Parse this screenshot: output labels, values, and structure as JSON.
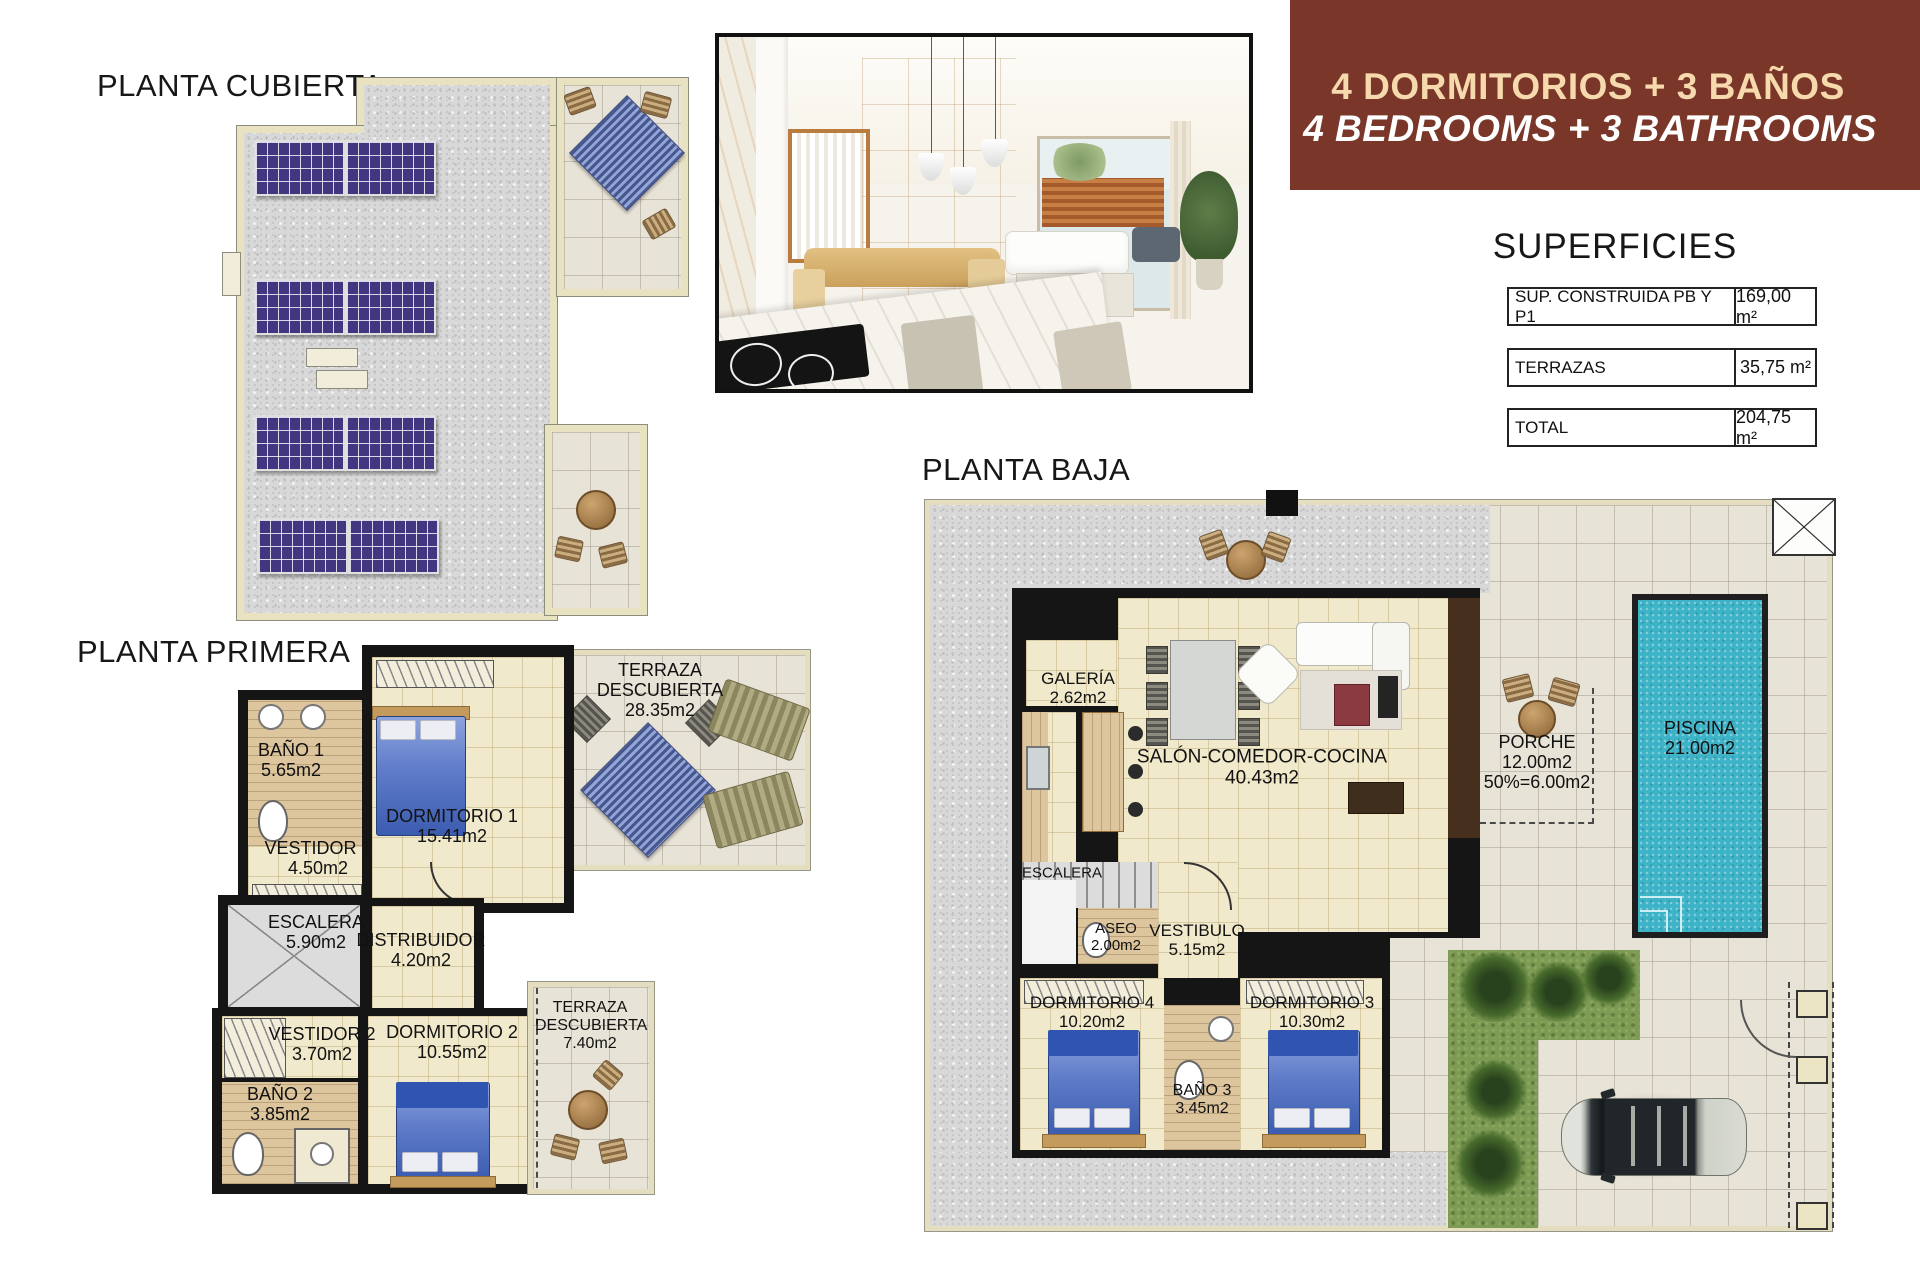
{
  "banner": {
    "line1": "4 DORMITORIOS + 3 BAÑOS",
    "line2": "4 BEDROOMS + 3 BATHROOMS",
    "bg_color": "#7a3629",
    "line1_color": "#f6d9ad",
    "line2_color": "#ffffff"
  },
  "superficies": {
    "title": "SUPERFICIES",
    "rows": [
      {
        "label": "SUP. CONSTRUIDA PB Y P1",
        "value": "169,00 m²"
      },
      {
        "label": "TERRAZAS",
        "value": "35,75 m²"
      },
      {
        "label": "TOTAL",
        "value": "204,75 m²"
      }
    ]
  },
  "plans": {
    "cubierta": {
      "title": "PLANTA CUBIERTA",
      "solar_color": "#41367f"
    },
    "primera": {
      "title": "PLANTA PRIMERA",
      "rooms": {
        "bano1": {
          "name": "BAÑO 1",
          "area": "5.65m2"
        },
        "vestidor1": {
          "name": "VESTIDOR 1",
          "area": "4.50m2"
        },
        "dormitorio1": {
          "name": "DORMITORIO 1",
          "area": "15.41m2"
        },
        "terraza1": {
          "name": "TERRAZA DESCUBIERTA",
          "area": "28.35m2"
        },
        "escalera": {
          "name": "ESCALERA",
          "area": "5.90m2"
        },
        "distribuidor": {
          "name": "DISTRIBUIDOR",
          "area": "4.20m2"
        },
        "vestidor2": {
          "name": "VESTIDOR 2",
          "area": "3.70m2"
        },
        "bano2": {
          "name": "BAÑO 2",
          "area": "3.85m2"
        },
        "dormitorio2": {
          "name": "DORMITORIO 2",
          "area": "10.55m2"
        },
        "terraza2": {
          "name": "TERRAZA DESCUBIERTA",
          "area": "7.40m2"
        }
      }
    },
    "baja": {
      "title": "PLANTA BAJA",
      "pool_color": "#3db3c7",
      "grass_color": "#7d9b53",
      "rooms": {
        "galeria": {
          "name": "GALERÍA",
          "area": "2.62m2"
        },
        "salon": {
          "name": "SALÓN-COMEDOR-COCINA",
          "area": "40.43m2"
        },
        "porche": {
          "name": "PORCHE",
          "area": "12.00m2",
          "area2": "50%=6.00m2"
        },
        "piscina": {
          "name": "PISCINA",
          "area": "21.00m2"
        },
        "escalera": {
          "name": "ESCALERA"
        },
        "aseo": {
          "name": "ASEO",
          "area": "2.00m2"
        },
        "vestibulo": {
          "name": "VESTIBULO",
          "area": "5.15m2"
        },
        "dormitorio4": {
          "name": "DORMITORIO 4",
          "area": "10.20m2"
        },
        "dormitorio3": {
          "name": "DORMITORIO 3",
          "area": "10.30m2"
        },
        "bano3": {
          "name": "BAÑO 3",
          "area": "3.45m2"
        }
      }
    }
  }
}
